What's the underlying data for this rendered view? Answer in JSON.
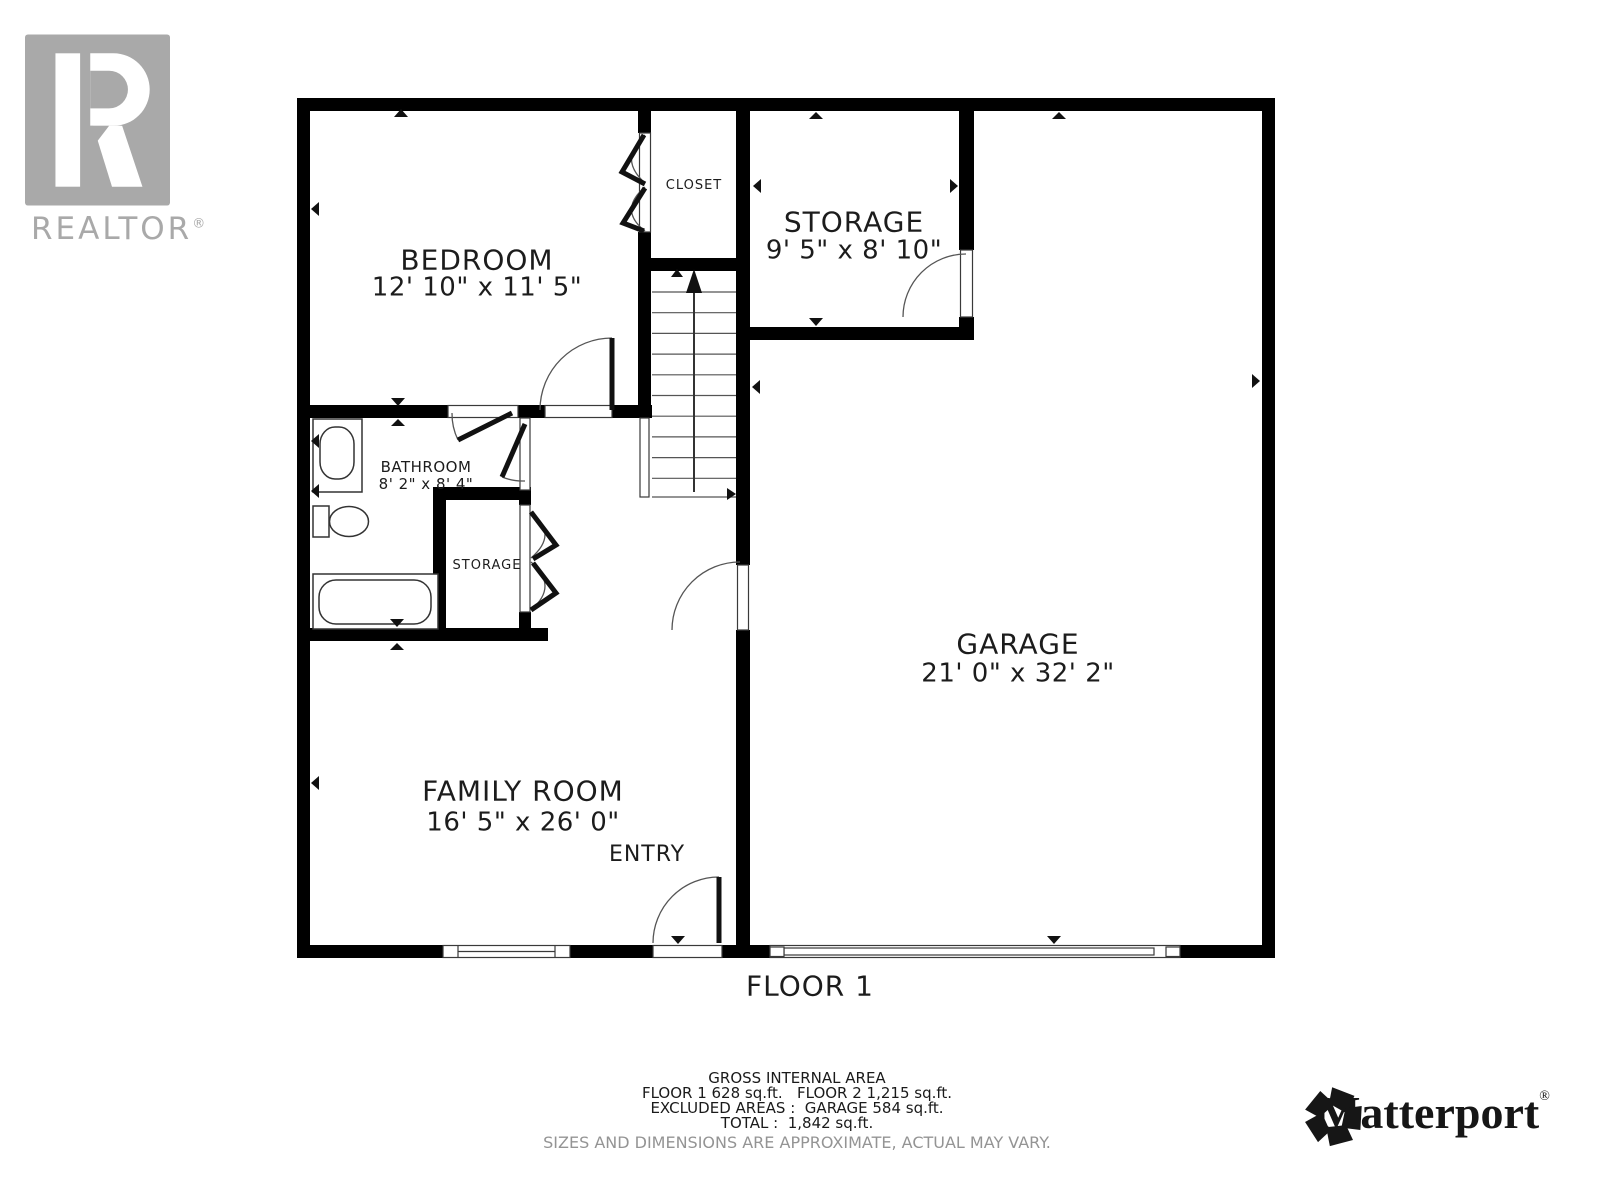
{
  "branding": {
    "realtor_logo_text": "REALTOR",
    "realtor_reg": "®",
    "matterport_text": "Matterport",
    "matterport_reg": "®"
  },
  "rooms": {
    "bedroom": {
      "name": "BEDROOM",
      "dims": "12' 10\" x 11' 5\""
    },
    "closet": {
      "name": "CLOSET"
    },
    "storage_upper": {
      "name": "STORAGE",
      "dims": "9' 5\" x 8' 10\""
    },
    "bathroom": {
      "name": "BATHROOM",
      "dims": "8' 2\" x 8' 4\""
    },
    "storage_closet": {
      "name": "STORAGE"
    },
    "garage": {
      "name": "GARAGE",
      "dims": "21' 0\" x 32' 2\""
    },
    "family_room": {
      "name": "FAMILY ROOM",
      "dims": "16' 5\" x 26' 0\""
    },
    "entry": {
      "name": "ENTRY"
    }
  },
  "floor_label": "FLOOR 1",
  "area_summary": {
    "title": "GROSS INTERNAL AREA",
    "line1": "FLOOR 1 628 sq.ft.   FLOOR 2 1,215 sq.ft.",
    "line2": "EXCLUDED AREAS :  GARAGE 584 sq.ft.",
    "line3": "TOTAL :  1,842 sq.ft.",
    "disclaimer": "SIZES AND DIMENSIONS ARE APPROXIMATE, ACTUAL MAY VARY."
  },
  "colors": {
    "wall": "#000000",
    "line": "#3a3a3a",
    "text": "#1c1c1c",
    "muted_text": "#949494",
    "logo_gray": "#a9a9a9"
  }
}
